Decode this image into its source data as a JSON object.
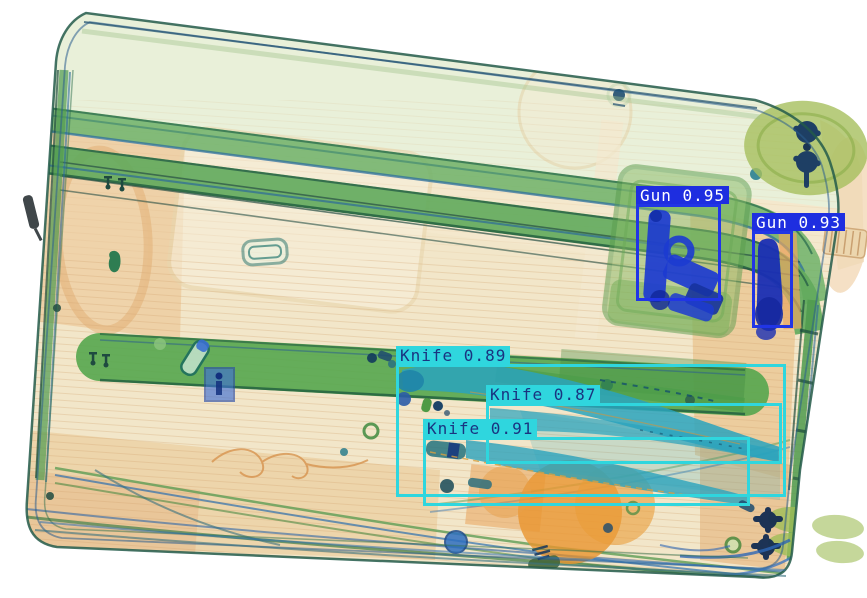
{
  "scene": {
    "kind": "xray-baggage-scan-with-detections",
    "palette": {
      "gun_box": "#2135e6",
      "gun_label_bg": "#1e2ee0",
      "gun_label_text": "#ffffff",
      "knife_box": "#2fd6de",
      "knife_label_bg": "#2fd6de",
      "knife_label_text": "#1a3480"
    }
  },
  "detections": [
    {
      "class": "Gun",
      "score": "0.95",
      "label": "Gun 0.95",
      "color": "#2135e6",
      "label_bg": "#1e2ee0",
      "text_color": "#ffffff",
      "box": {
        "x": 636,
        "y": 204,
        "w": 85,
        "h": 97
      }
    },
    {
      "class": "Gun",
      "score": "0.93",
      "label": "Gun 0.93",
      "color": "#2135e6",
      "label_bg": "#1e2ee0",
      "text_color": "#ffffff",
      "box": {
        "x": 752,
        "y": 231,
        "w": 41,
        "h": 97
      }
    },
    {
      "class": "Knife",
      "score": "0.89",
      "label": "Knife 0.89",
      "color": "#2fd6de",
      "label_bg": "#2fd6de",
      "text_color": "#1a3480",
      "box": {
        "x": 396,
        "y": 364,
        "w": 390,
        "h": 133
      }
    },
    {
      "class": "Knife",
      "score": "0.87",
      "label": "Knife 0.87",
      "color": "#2fd6de",
      "label_bg": "#2fd6de",
      "text_color": "#1a3480",
      "box": {
        "x": 486,
        "y": 403,
        "w": 296,
        "h": 61
      }
    },
    {
      "class": "Knife",
      "score": "0.91",
      "label": "Knife 0.91",
      "color": "#2fd6de",
      "label_bg": "#2fd6de",
      "text_color": "#1a3480",
      "box": {
        "x": 423,
        "y": 437,
        "w": 327,
        "h": 69
      }
    }
  ]
}
